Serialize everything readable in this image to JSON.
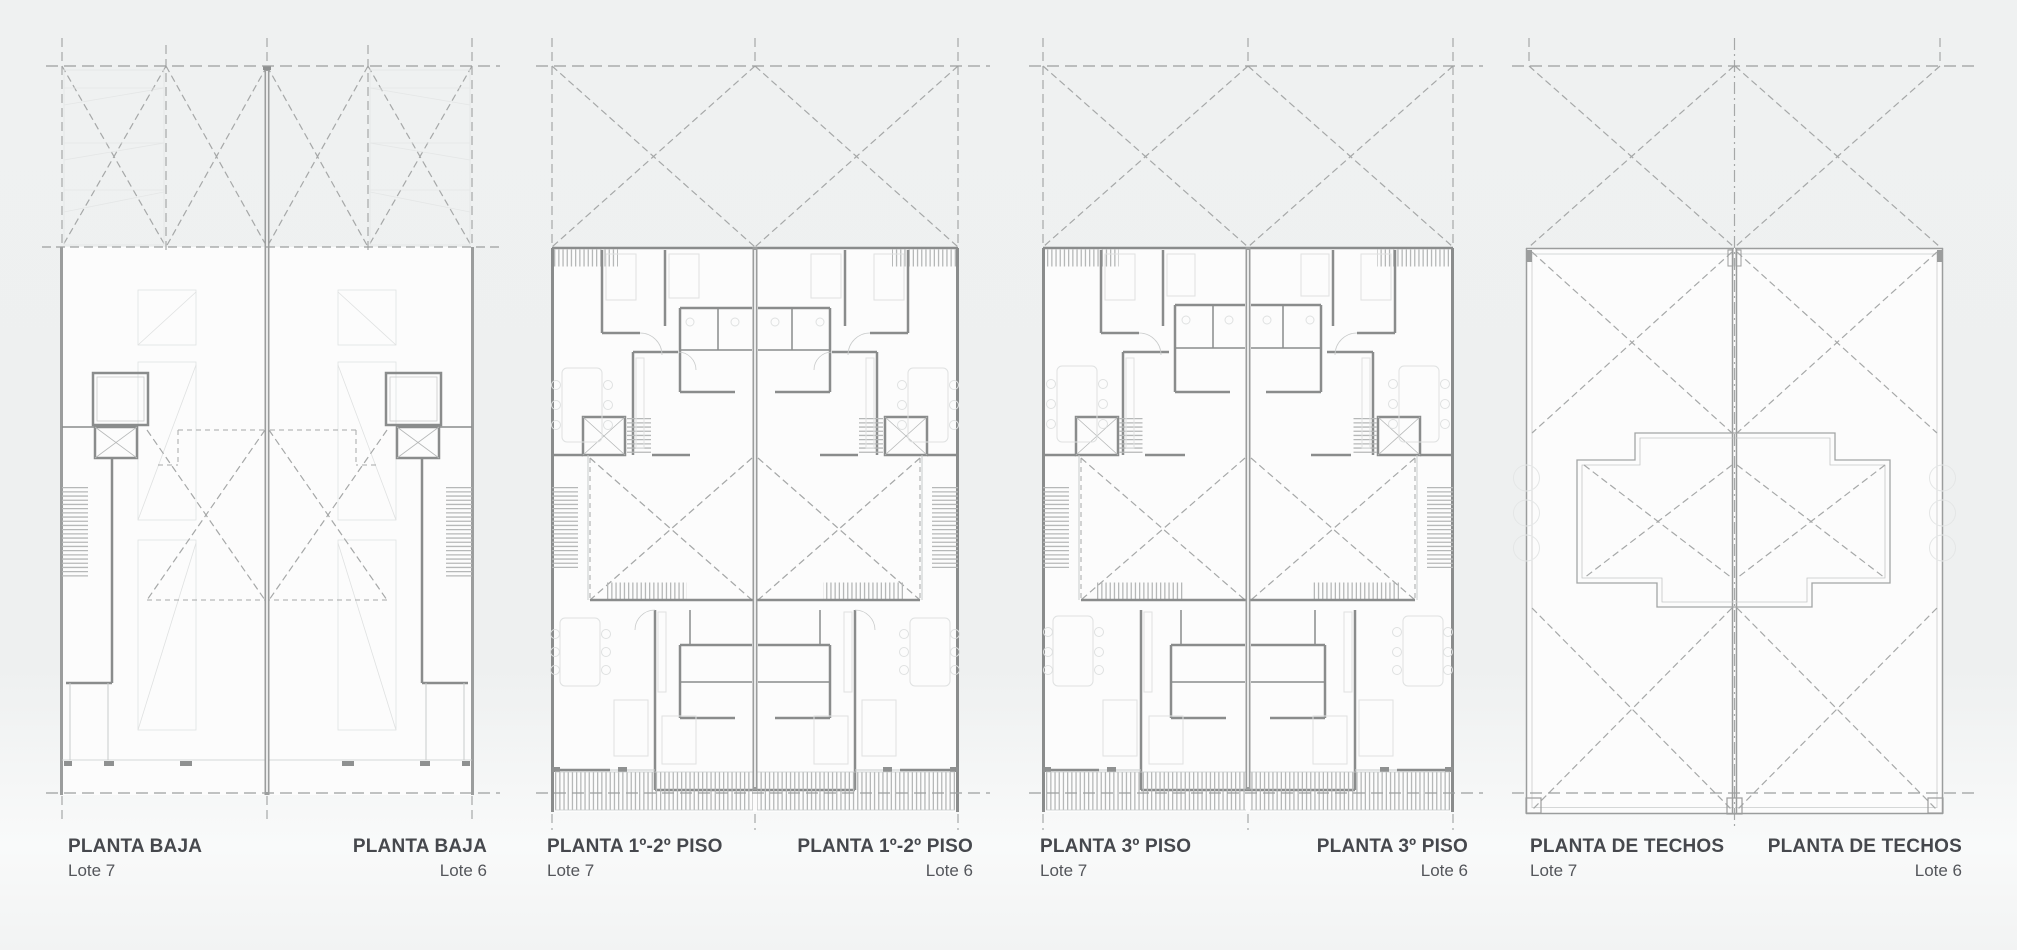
{
  "page": {
    "background_top": "#eff1f1",
    "background_bottom": "#f2f3f3",
    "title_color": "#46484d",
    "subtitle_color": "#54565b",
    "wall_color": "#8a8c8c",
    "dashed_grid_color": "#a6a8a8"
  },
  "plans": [
    {
      "id": "planta-baja",
      "title_left": "PLANTA BAJA",
      "lot_left": "Lote 7",
      "title_right": "PLANTA BAJA",
      "lot_right": "Lote 6"
    },
    {
      "id": "planta-1-2-piso",
      "title_left": "PLANTA 1º-2º PISO",
      "lot_left": "Lote 7",
      "title_right": "PLANTA 1º-2º PISO",
      "lot_right": "Lote 6"
    },
    {
      "id": "planta-3-piso",
      "title_left": "PLANTA 3º PISO",
      "lot_left": "Lote 7",
      "title_right": "PLANTA 3º PISO",
      "lot_right": "Lote 6"
    },
    {
      "id": "planta-de-techos",
      "title_left": "PLANTA DE TECHOS",
      "lot_left": "Lote 7",
      "title_right": "PLANTA DE TECHOS",
      "lot_right": "Lote 6"
    }
  ]
}
